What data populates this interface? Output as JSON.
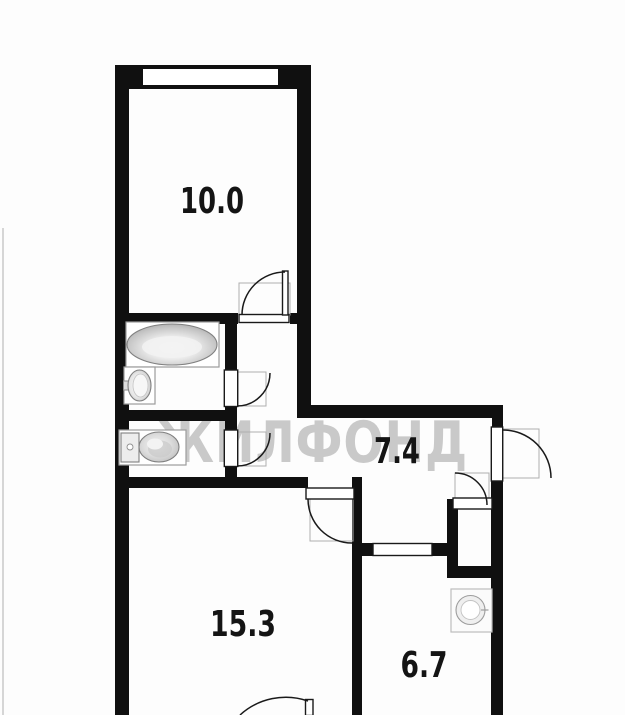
{
  "floorplan": {
    "watermark_text": "ЖИЛФОНД",
    "rooms": [
      {
        "id": "room-top",
        "area": "10.0"
      },
      {
        "id": "hallway",
        "area": "7.4"
      },
      {
        "id": "room-bottom-left",
        "area": "15.3"
      },
      {
        "id": "room-bottom-right",
        "area": "6.7"
      }
    ],
    "colors": {
      "wall": "#101010",
      "watermark": "#c9c9c9",
      "label": "#141414",
      "background": "#fdfdfd"
    }
  }
}
